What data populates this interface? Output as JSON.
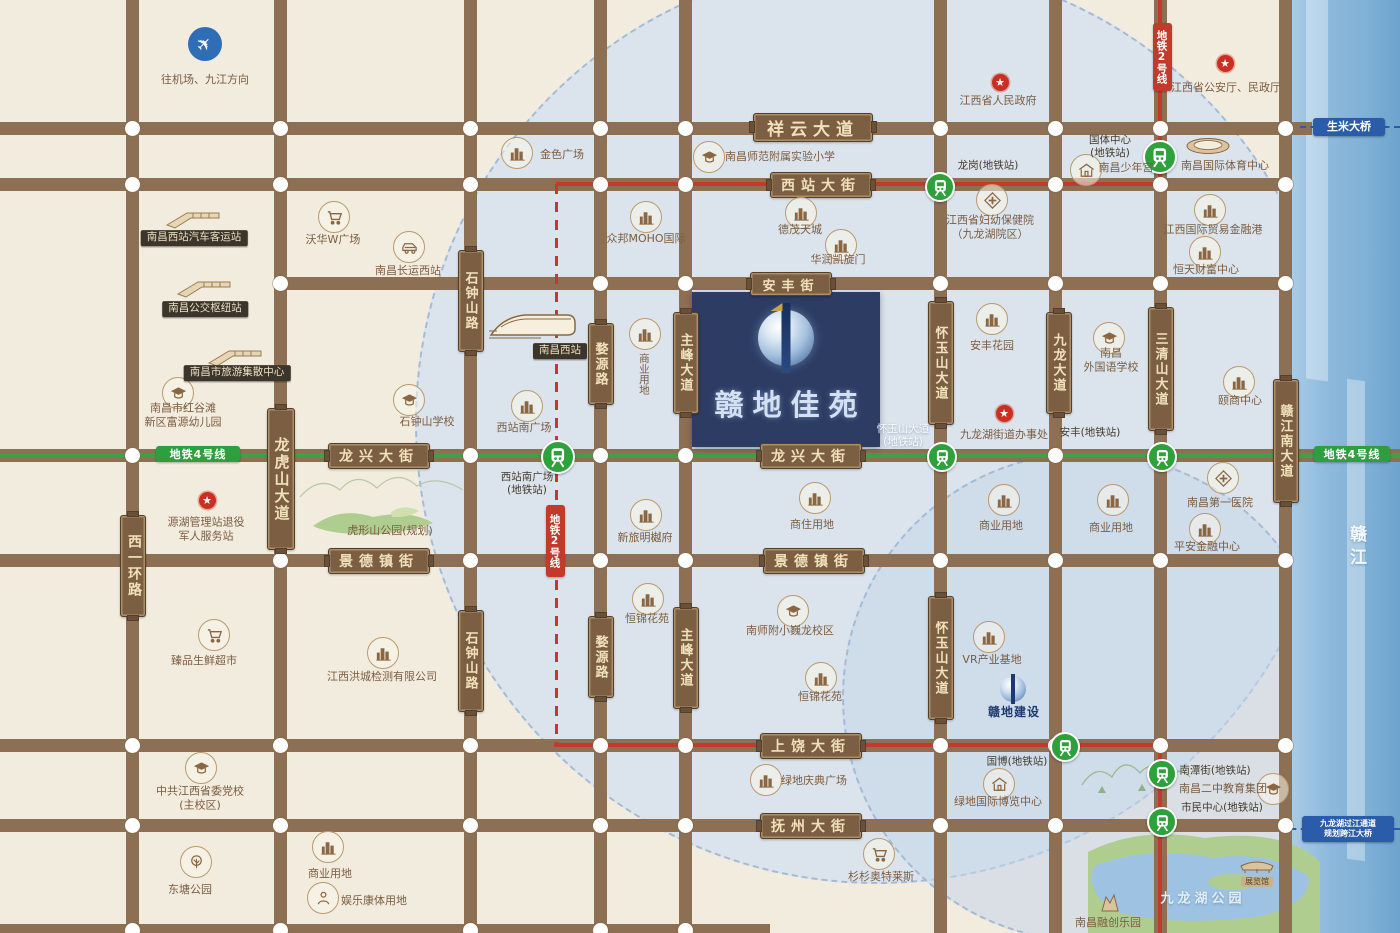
{
  "property": {
    "name": "赣地佳苑"
  },
  "river": {
    "name": "赣江"
  },
  "parks": {
    "jiulonghu_label": "九龙湖公园"
  },
  "bridges": [
    {
      "label": "生米大桥",
      "x": 1349,
      "y": 127,
      "w": 72,
      "h": 18,
      "fs": 11
    },
    {
      "label": "九龙湖过江通道\n规划跨江大桥",
      "x": 1348,
      "y": 829,
      "w": 92,
      "h": 26,
      "fs": 8
    }
  ],
  "metro_badges": [
    {
      "label": "地铁2号线",
      "color": "red",
      "x": 1162,
      "y": 57,
      "w": 19,
      "h": 68
    },
    {
      "label": "地铁2号线",
      "color": "red",
      "x": 555,
      "y": 541,
      "w": 19,
      "h": 72
    },
    {
      "label": "地铁4号线",
      "color": "green",
      "x": 198,
      "y": 454,
      "w": 84,
      "h": 16
    },
    {
      "label": "地铁4号线",
      "color": "green",
      "x": 1352,
      "y": 454,
      "w": 76,
      "h": 16
    }
  ],
  "roads": {
    "horizontal": [
      {
        "y": 128,
        "x1": 0,
        "x2": 1312
      },
      {
        "y": 184,
        "x1": 0,
        "x2": 1292
      },
      {
        "y": 283,
        "x1": 278,
        "x2": 1292
      },
      {
        "y": 455,
        "x1": 0,
        "x2": 1400
      },
      {
        "y": 560,
        "x1": 0,
        "x2": 1292
      },
      {
        "y": 745,
        "x1": 0,
        "x2": 1292
      },
      {
        "y": 825,
        "x1": 0,
        "x2": 1292
      },
      {
        "y": 930,
        "x1": 0,
        "x2": 770
      }
    ],
    "vertical": [
      {
        "x": 132,
        "y1": 0,
        "y2": 933
      },
      {
        "x": 280,
        "y1": 0,
        "y2": 933
      },
      {
        "x": 470,
        "y1": 0,
        "y2": 933
      },
      {
        "x": 600,
        "y1": 0,
        "y2": 933
      },
      {
        "x": 685,
        "y1": 0,
        "y2": 933
      },
      {
        "x": 940,
        "y1": 0,
        "y2": 933
      },
      {
        "x": 1055,
        "y1": 0,
        "y2": 933
      },
      {
        "x": 1160,
        "y1": 0,
        "y2": 933
      },
      {
        "x": 1285,
        "y1": 0,
        "y2": 933
      }
    ]
  },
  "road_signs": [
    {
      "label": "祥云大道",
      "x": 812,
      "y": 126,
      "w": 118,
      "h": 27,
      "fs": 17
    },
    {
      "label": "西站大街",
      "x": 820,
      "y": 184,
      "w": 100,
      "h": 24,
      "fs": 14
    },
    {
      "label": "安丰街",
      "x": 790,
      "y": 283,
      "w": 80,
      "h": 22,
      "fs": 13
    },
    {
      "label": "龙兴大街",
      "x": 378,
      "y": 455,
      "w": 100,
      "h": 24,
      "fs": 14
    },
    {
      "label": "龙兴大街",
      "x": 810,
      "y": 455,
      "w": 100,
      "h": 24,
      "fs": 14
    },
    {
      "label": "景德镇街",
      "x": 378,
      "y": 560,
      "w": 100,
      "h": 24,
      "fs": 14
    },
    {
      "label": "景德镇街",
      "x": 813,
      "y": 560,
      "w": 100,
      "h": 24,
      "fs": 14
    },
    {
      "label": "上饶大街",
      "x": 810,
      "y": 745,
      "w": 100,
      "h": 24,
      "fs": 14
    },
    {
      "label": "抚州大街",
      "x": 810,
      "y": 825,
      "w": 100,
      "h": 24,
      "fs": 14
    },
    {
      "label": "西一环路",
      "v": 1,
      "x": 132,
      "y": 565,
      "w": 24,
      "h": 100,
      "fs": 14
    },
    {
      "label": "龙虎山大道",
      "v": 1,
      "x": 280,
      "y": 478,
      "w": 26,
      "h": 140,
      "fs": 15
    },
    {
      "label": "石钟山路",
      "v": 1,
      "x": 470,
      "y": 300,
      "w": 24,
      "h": 100,
      "fs": 13
    },
    {
      "label": "石钟山路",
      "v": 1,
      "x": 470,
      "y": 660,
      "w": 24,
      "h": 100,
      "fs": 13
    },
    {
      "label": "婺源路",
      "v": 1,
      "x": 600,
      "y": 363,
      "w": 24,
      "h": 80,
      "fs": 13
    },
    {
      "label": "婺源路",
      "v": 1,
      "x": 600,
      "y": 656,
      "w": 24,
      "h": 80,
      "fs": 13
    },
    {
      "label": "主峰大道",
      "v": 1,
      "x": 685,
      "y": 362,
      "w": 24,
      "h": 100,
      "fs": 13
    },
    {
      "label": "主峰大道",
      "v": 1,
      "x": 685,
      "y": 657,
      "w": 24,
      "h": 100,
      "fs": 13
    },
    {
      "label": "怀玉山大道",
      "v": 1,
      "x": 940,
      "y": 362,
      "w": 24,
      "h": 122,
      "fs": 13
    },
    {
      "label": "怀玉山大道",
      "v": 1,
      "x": 940,
      "y": 657,
      "w": 24,
      "h": 122,
      "fs": 13
    },
    {
      "label": "九龙大道",
      "v": 1,
      "x": 1058,
      "y": 362,
      "w": 24,
      "h": 100,
      "fs": 13
    },
    {
      "label": "三清山大道",
      "v": 1,
      "x": 1160,
      "y": 368,
      "w": 24,
      "h": 122,
      "fs": 13
    },
    {
      "label": "赣江南大道",
      "v": 1,
      "x": 1285,
      "y": 440,
      "w": 24,
      "h": 122,
      "fs": 13
    }
  ],
  "stations": [
    {
      "label": "西站南广场\n(地铁站)",
      "x": 556,
      "y": 455,
      "lx": 527,
      "ly": 484,
      "size": 30
    },
    {
      "label": "怀玉山大道\n(地铁站)",
      "x": 940,
      "y": 455,
      "lx": 903,
      "ly": 436,
      "white": 1
    },
    {
      "label": "安丰(地铁站)",
      "x": 1160,
      "y": 455,
      "lx": 1090,
      "ly": 433
    },
    {
      "label": "龙岗(地铁站)",
      "x": 938,
      "y": 185,
      "lx": 988,
      "ly": 166
    },
    {
      "label": "国体中心\n(地铁站)",
      "x": 1158,
      "y": 155,
      "lx": 1110,
      "ly": 147,
      "size": 30
    },
    {
      "label": "国博(地铁站)",
      "x": 1063,
      "y": 745,
      "lx": 1017,
      "ly": 762
    },
    {
      "label": "南潭街(地铁站)",
      "x": 1160,
      "y": 772,
      "lx": 1215,
      "ly": 771
    },
    {
      "label": "市民中心(地铁站)",
      "x": 1160,
      "y": 820,
      "lx": 1222,
      "ly": 808
    }
  ],
  "landmarks": [
    {
      "t": "plane",
      "x": 205,
      "y": 44,
      "label": "往机场、九江方向",
      "lx": 205,
      "ly": 80
    },
    {
      "t": "hub",
      "x": 193,
      "y": 218,
      "label": "南昌西站汽车客运站",
      "lx": 194,
      "ly": 238,
      "badge": 1
    },
    {
      "t": "hub",
      "x": 204,
      "y": 287,
      "label": "南昌公交枢纽站",
      "lx": 205,
      "ly": 309,
      "badge": 1
    },
    {
      "t": "hub",
      "x": 235,
      "y": 356,
      "label": "南昌市旅游集散中心",
      "lx": 237,
      "ly": 373,
      "badge": 1
    },
    {
      "t": "school",
      "x": 177,
      "y": 392,
      "label": "南昌市红谷滩\n新区富源幼儿园",
      "lx": 183,
      "ly": 416
    },
    {
      "t": "bldg",
      "x": 516,
      "y": 152,
      "label": "金色广场",
      "lx": 562,
      "ly": 155
    },
    {
      "t": "cart",
      "x": 333,
      "y": 216,
      "label": "沃华W广场",
      "lx": 333,
      "ly": 240
    },
    {
      "t": "car",
      "x": 408,
      "y": 246,
      "label": "南昌长运西站",
      "lx": 408,
      "ly": 271
    },
    {
      "t": "hsr",
      "x": 533,
      "y": 324,
      "label": "南昌西站",
      "lx": 560,
      "ly": 351,
      "badge": 1
    },
    {
      "t": "bldg",
      "x": 526,
      "y": 405,
      "label": "西站南广场",
      "lx": 524,
      "ly": 428
    },
    {
      "t": "school",
      "x": 408,
      "y": 399,
      "label": "石钟山学校",
      "lx": 427,
      "ly": 422
    },
    {
      "t": "none",
      "x": 0,
      "y": 0,
      "label": "虎形山公园(规划)",
      "lx": 390,
      "ly": 531
    },
    {
      "t": "star",
      "x": 207,
      "y": 500,
      "label": "源湖管理站退役\n军人服务站",
      "lx": 206,
      "ly": 530
    },
    {
      "t": "cart",
      "x": 213,
      "y": 634,
      "label": "臻品生鲜超市",
      "lx": 204,
      "ly": 661
    },
    {
      "t": "bldg",
      "x": 382,
      "y": 652,
      "label": "江西洪城检测有限公司",
      "lx": 382,
      "ly": 677
    },
    {
      "t": "school",
      "x": 200,
      "y": 767,
      "label": "中共江西省委党校\n(主校区)",
      "lx": 200,
      "ly": 799
    },
    {
      "t": "tree",
      "x": 195,
      "y": 861,
      "label": "东塘公园",
      "lx": 190,
      "ly": 890
    },
    {
      "t": "bldg",
      "x": 327,
      "y": 846,
      "label": "商业用地",
      "lx": 330,
      "ly": 874
    },
    {
      "t": "person",
      "x": 322,
      "y": 897,
      "label": "娱乐康体用地",
      "lx": 374,
      "ly": 901
    },
    {
      "t": "bldg",
      "x": 645,
      "y": 216,
      "label": "众邦MOHO国际",
      "lx": 646,
      "ly": 239
    },
    {
      "t": "bldg",
      "x": 644,
      "y": 333,
      "label": "商业用地",
      "lx": 643,
      "ly": 374,
      "vert": 1
    },
    {
      "t": "school",
      "x": 708,
      "y": 156,
      "label": "南昌师范附属实验小学",
      "lx": 780,
      "ly": 157
    },
    {
      "t": "bldg",
      "x": 800,
      "y": 212,
      "label": "德茂天城",
      "lx": 800,
      "ly": 230
    },
    {
      "t": "bldg",
      "x": 840,
      "y": 244,
      "label": "华润凯旋门",
      "lx": 838,
      "ly": 260
    },
    {
      "t": "cross",
      "x": 991,
      "y": 199,
      "label": "江西省妇幼保健院\n（九龙湖院区）",
      "lx": 990,
      "ly": 228
    },
    {
      "t": "star",
      "x": 1000,
      "y": 82,
      "label": "江西省人民政府",
      "lx": 998,
      "ly": 101
    },
    {
      "t": "star",
      "x": 1225,
      "y": 63,
      "label": "江西省公安厅、民政厅",
      "lx": 1226,
      "ly": 88
    },
    {
      "t": "bldg",
      "x": 1209,
      "y": 209,
      "label": "江西国际贸易金融港",
      "lx": 1213,
      "ly": 230
    },
    {
      "t": "bldg",
      "x": 1204,
      "y": 251,
      "label": "恒天财富中心",
      "lx": 1206,
      "ly": 270
    },
    {
      "t": "house",
      "x": 1085,
      "y": 169,
      "label": "南昌少年宫",
      "lx": 1126,
      "ly": 168
    },
    {
      "t": "stadium",
      "x": 1208,
      "y": 146,
      "label": "南昌国际体育中心",
      "lx": 1225,
      "ly": 166
    },
    {
      "t": "bldg",
      "x": 991,
      "y": 318,
      "label": "安丰花园",
      "lx": 992,
      "ly": 346
    },
    {
      "t": "school",
      "x": 1108,
      "y": 337,
      "label": "南昌\n外国语学校",
      "lx": 1111,
      "ly": 361
    },
    {
      "t": "bldg",
      "x": 1238,
      "y": 381,
      "label": "颐商中心",
      "lx": 1240,
      "ly": 401
    },
    {
      "t": "star",
      "x": 1004,
      "y": 413,
      "label": "九龙湖街道办事处",
      "lx": 1004,
      "ly": 435
    },
    {
      "t": "bldg",
      "x": 1003,
      "y": 499,
      "label": "商业用地",
      "lx": 1001,
      "ly": 526
    },
    {
      "t": "bldg",
      "x": 1112,
      "y": 499,
      "label": "商业用地",
      "lx": 1111,
      "ly": 528
    },
    {
      "t": "cross",
      "x": 1222,
      "y": 477,
      "label": "南昌第一医院",
      "lx": 1220,
      "ly": 503
    },
    {
      "t": "bldg",
      "x": 1204,
      "y": 528,
      "label": "平安金融中心",
      "lx": 1207,
      "ly": 547
    },
    {
      "t": "bldg",
      "x": 645,
      "y": 514,
      "label": "新旅明樾府",
      "lx": 645,
      "ly": 538
    },
    {
      "t": "bldg",
      "x": 647,
      "y": 598,
      "label": "恒锦花苑",
      "lx": 647,
      "ly": 619
    },
    {
      "t": "bldg",
      "x": 814,
      "y": 497,
      "label": "商住用地",
      "lx": 812,
      "ly": 525
    },
    {
      "t": "school",
      "x": 792,
      "y": 610,
      "label": "南师附小巍龙校区",
      "lx": 790,
      "ly": 631
    },
    {
      "t": "bldg",
      "x": 820,
      "y": 677,
      "label": "恒锦花苑",
      "lx": 820,
      "ly": 697
    },
    {
      "t": "bldg",
      "x": 988,
      "y": 636,
      "label": "VR产业基地",
      "lx": 992,
      "ly": 660
    },
    {
      "t": "logo",
      "x": 1013,
      "y": 689,
      "label": "赣地建设",
      "lx": 1014,
      "ly": 713
    },
    {
      "t": "bldg",
      "x": 765,
      "y": 779,
      "label": "绿地庆典广场",
      "lx": 814,
      "ly": 781
    },
    {
      "t": "house",
      "x": 998,
      "y": 783,
      "label": "绿地国际博览中心",
      "lx": 998,
      "ly": 802
    },
    {
      "t": "cart",
      "x": 878,
      "y": 853,
      "label": "杉杉奥特莱斯",
      "lx": 881,
      "ly": 877
    },
    {
      "t": "theme",
      "x": 1110,
      "y": 903,
      "label": "南昌融创乐园",
      "lx": 1108,
      "ly": 923
    },
    {
      "t": "civic",
      "x": 1257,
      "y": 865,
      "label": "展览馆",
      "lx": 1257,
      "ly": 882,
      "badge": 2
    },
    {
      "t": "school",
      "x": 1272,
      "y": 788,
      "label": "南昌二中教育集团",
      "lx": 1223,
      "ly": 789
    },
    {
      "t": "none",
      "x": 0,
      "y": 0,
      "label": "九龙湖公园",
      "lx": 1203,
      "ly": 900,
      "light": 1
    }
  ]
}
